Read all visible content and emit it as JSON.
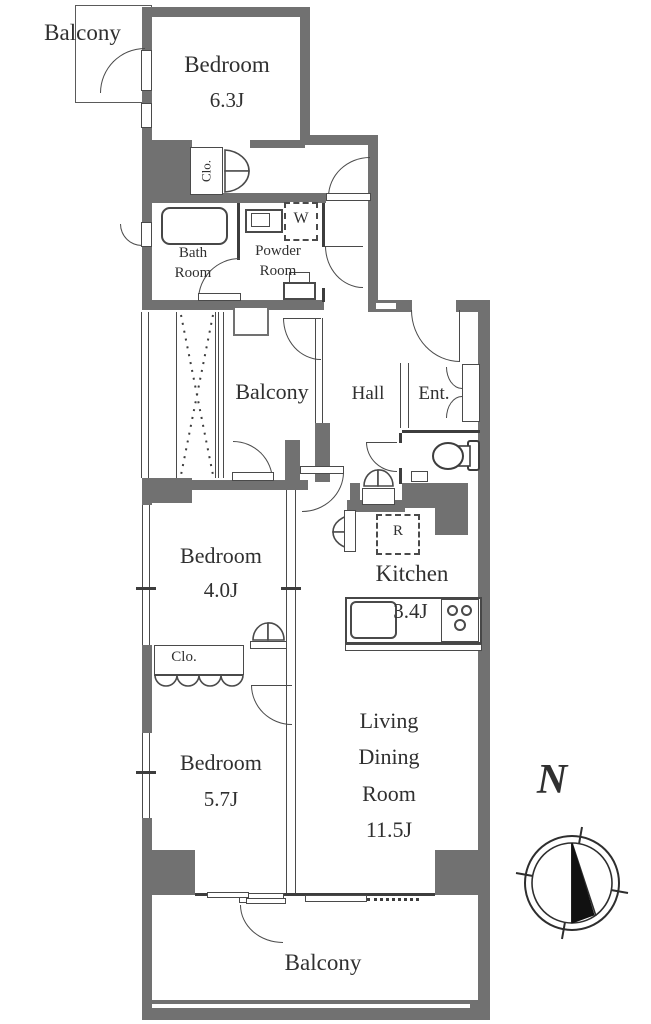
{
  "colors": {
    "wall": "#717171",
    "line": "#4a4a4a"
  },
  "rooms": {
    "balcony_top": {
      "label": "Balcony"
    },
    "bedroom1": {
      "name": "Bedroom",
      "size": "6.3J"
    },
    "closet1": {
      "label": "Clo."
    },
    "bath": {
      "line1": "Bath",
      "line2": "Room"
    },
    "powder": {
      "line1": "Powder",
      "line2": "Room"
    },
    "washer": {
      "label": "W"
    },
    "balcony_inner": {
      "label": "Balcony"
    },
    "hall": {
      "label": "Hall"
    },
    "entrance": {
      "label": "Ent."
    },
    "bedroom2": {
      "name": "Bedroom",
      "size": "4.0J"
    },
    "kitchen": {
      "name": "Kitchen",
      "size": "3.4J"
    },
    "fridge": {
      "label": "R"
    },
    "closet2": {
      "label": "Clo."
    },
    "bedroom3": {
      "name": "Bedroom",
      "size": "5.7J"
    },
    "living": {
      "line1": "Living",
      "line2": "Dining",
      "line3": "Room",
      "size": "11.5J"
    },
    "balcony_bottom": {
      "label": "Balcony"
    }
  },
  "compass": {
    "north_label": "N"
  }
}
